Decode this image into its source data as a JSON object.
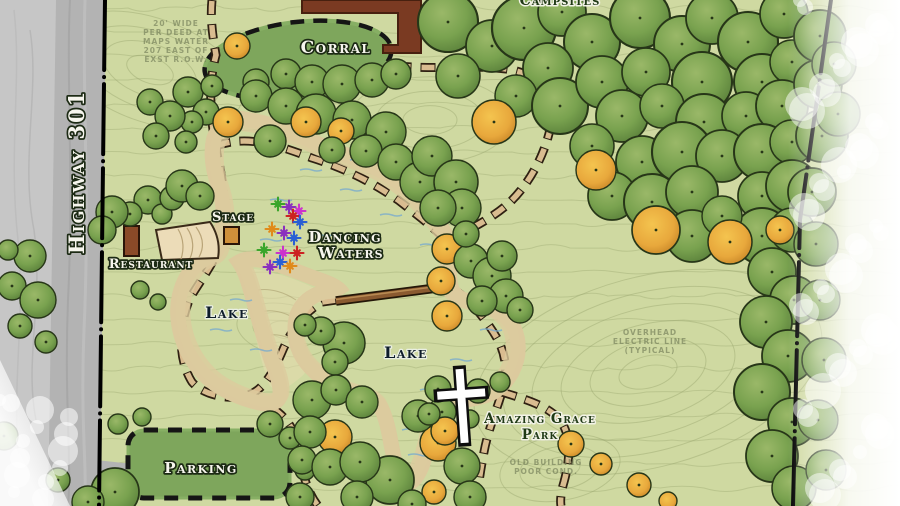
{
  "map": {
    "road_label": "Highway 301",
    "labels": {
      "corral": "Corral",
      "stage": "Stage",
      "restaurant": "Restaurant",
      "dancing_waters_line1": "Dancing",
      "dancing_waters_line2": "Waters",
      "lake_west": "Lake",
      "lake_south": "Lake",
      "amazing_grace_line1": "Amazing Grace",
      "amazing_grace_line2": "Park",
      "parking": "Parking",
      "cutoff_top": "Campsites"
    },
    "survey_notes": {
      "deed_lines": [
        "20' WIDE",
        "PER DEED AT",
        "MAPS WATER",
        "207 EAST OF",
        "EXST R.O.W."
      ],
      "electric_lines": [
        "OVERHEAD",
        "ELECTRIC LINE",
        "(TYPICAL)"
      ],
      "building_lines": [
        "OLD BUILDING",
        "POOR COND."
      ]
    },
    "icons": {
      "cross": "church-cross-icon",
      "bridge": "footbridge-icon",
      "fountain": "dancing-waters-fountain-icon"
    },
    "colors": {
      "water": "#4e8ab5",
      "water_outline": "#14222e",
      "meadow": "#cfd9a1",
      "canopy_green": "#6f9a4a",
      "canopy_fall": "#e8a83c",
      "trail_tan": "#d9bc90",
      "road_gray": "#b3b3b3",
      "building_brown": "#7a3a22",
      "field_green": "#7ea65c"
    }
  }
}
